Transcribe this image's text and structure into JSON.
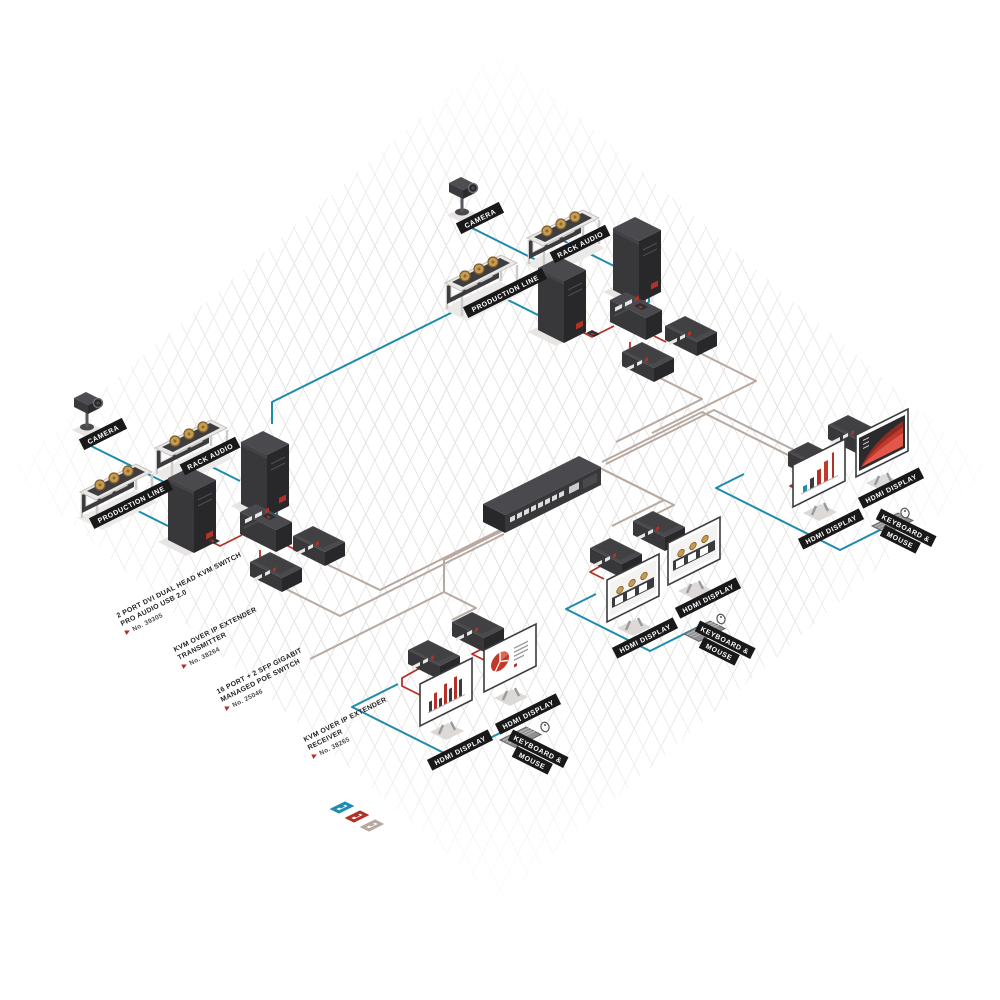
{
  "labels": {
    "camera": "CAMERA",
    "rack_audio": "RACK AUDIO",
    "production_line": "PRODUCTION LINE",
    "hdmi_display": "HDMI DISPLAY",
    "keyboard_mouse_l1": "KEYBOARD &",
    "keyboard_mouse_l2": "MOUSE",
    "arrow_icon": "➜"
  },
  "products": {
    "kvm_switch": {
      "l1": "2 PORT DVI DUAL HEAD KVM SWITCH",
      "l2": "PRO AUDIO USB 2.0",
      "no": "No. 39305"
    },
    "ip_tx": {
      "l1": "KVM OVER IP EXTENDER",
      "l2": "TRANSMITTER",
      "no": "No. 38264"
    },
    "poe_switch": {
      "l1": "16 PORT + 2 SFP GIGABIT",
      "l2": "MANAGED POE SWITCH",
      "no": "No. 25046"
    },
    "ip_rx": {
      "l1": "KVM OVER IP EXTENDER",
      "l2": "RECEIVER",
      "no": "No. 38265"
    }
  },
  "legend": {
    "swatches": [
      {
        "id": "usb-km-signal",
        "hex": "#1e8cab"
      },
      {
        "id": "video-signal",
        "hex": "#b33127"
      },
      {
        "id": "network-cat",
        "hex": "#b7a8a0"
      }
    ]
  },
  "colors": {
    "device_top": "#4a4a4e",
    "device_front": "#38383b",
    "device_side": "#28282b",
    "gold_knob": "#c79b51",
    "label_bg": "#191919",
    "grid_line": "#e6e4e2"
  }
}
